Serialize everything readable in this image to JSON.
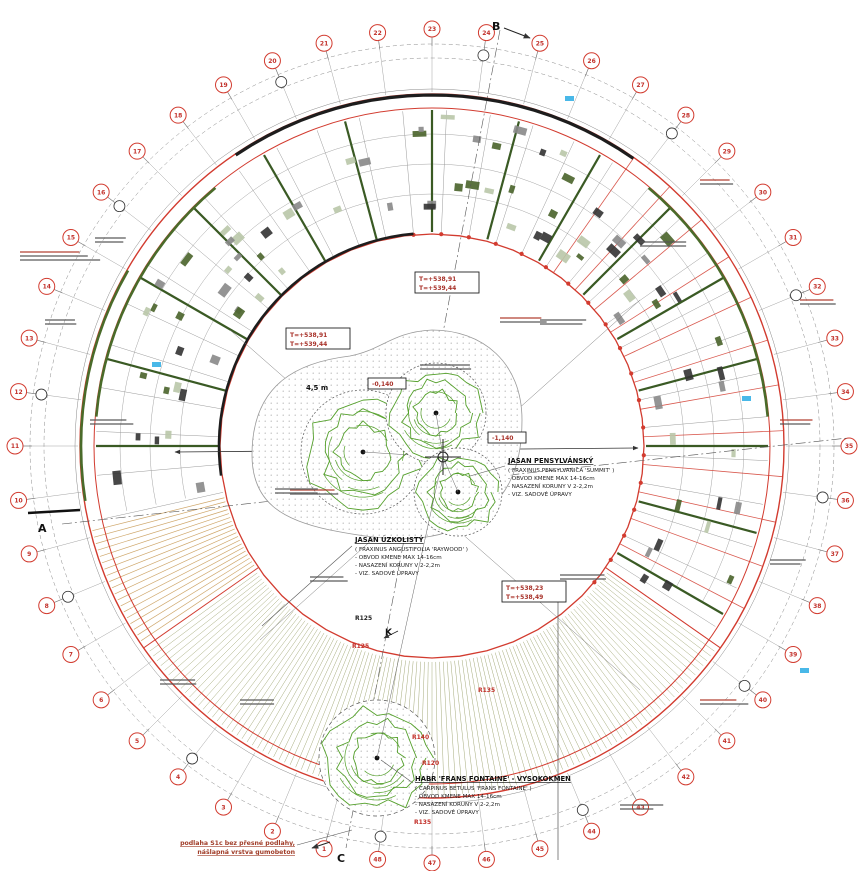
{
  "plan": {
    "colors": {
      "grid_red": "#d23b2f",
      "wall_green": "#3a5a24",
      "facade_olive": "#4a6b2a",
      "tree_green": "#55a02c",
      "hatch_olive": "#9aa06a",
      "terrace_tan": "#cfa76b",
      "dim_gray": "#8a8a8a",
      "fixture_blue": "#49b8e8",
      "note_red": "#a03c28"
    },
    "tree_labels": [
      {
        "title": "JASAN PENSYLVÁNSKÝ",
        "lines": [
          "( FRAXINUS PENSYLVANICA 'SUMMIT' )",
          "- OBVOD KMENE  MAX 14-16cm",
          "- NASAZENÍ KORUNY V 2-2,2m",
          "- VIZ. SADOVÉ ÚPRAVY"
        ]
      },
      {
        "title": "JASAN ÚZKOLISTÝ",
        "lines": [
          "( FRAXINUS ANGUSTIFOLIA 'RAYWOOD' )",
          "- OBVOD KMENE  MAX 14-16cm",
          "- NASAZENÍ KORUNY V 2-2,2m",
          "- VIZ. SADOVÉ ÚPRAVY"
        ]
      },
      {
        "title": "HABR 'FRANS FONTAINE' - VYSOKOKMEN",
        "lines": [
          "( CARPINUS BETULUS 'FRANS FONTAINE' )",
          "- OBVOD KMENE  MAX 14-16cm",
          "- NASAZENÍ KORUNY V 2-2,2m",
          "- VIZ. SADOVÉ ÚPRAVY"
        ]
      }
    ],
    "floor_note": {
      "lines": [
        "podlaha S1c bez přesné podlahy,",
        "nášlapná vrstva gumobeton"
      ]
    },
    "elevation_boxes": [
      {
        "lines": [
          "T=+538,91",
          "T=+539,44"
        ]
      },
      {
        "lines": [
          "T=+538,91",
          "T=+539,44"
        ]
      },
      {
        "lines": [
          "T=+538,23",
          "T=+538,49"
        ]
      },
      {
        "lines": [
          "-1,140"
        ]
      },
      {
        "lines": [
          "-0,140"
        ]
      }
    ],
    "section_markers": [
      {
        "label": "A"
      },
      {
        "label": "B"
      },
      {
        "label": "C"
      },
      {
        "label": "K"
      }
    ],
    "radius_labels": [
      {
        "text": "R125",
        "color": "black"
      },
      {
        "text": "R125",
        "color": "red"
      },
      {
        "text": "R140",
        "color": "red"
      },
      {
        "text": "R120",
        "color": "red"
      },
      {
        "text": "R135",
        "color": "red"
      },
      {
        "text": "R135",
        "color": "red"
      }
    ],
    "misc_labels": [
      {
        "text": "4,5 m"
      }
    ],
    "grid": {
      "bubble_numbers": [
        1,
        2,
        3,
        4,
        5,
        6,
        7,
        8,
        9,
        10,
        11,
        12,
        13,
        14,
        15,
        16,
        17,
        18,
        19,
        20,
        21,
        22,
        23,
        24,
        25,
        26,
        27,
        28,
        29,
        30,
        31,
        32,
        33,
        34,
        35,
        36,
        37,
        38,
        39,
        40,
        41,
        42,
        43,
        44,
        45,
        46,
        47,
        48
      ]
    }
  }
}
